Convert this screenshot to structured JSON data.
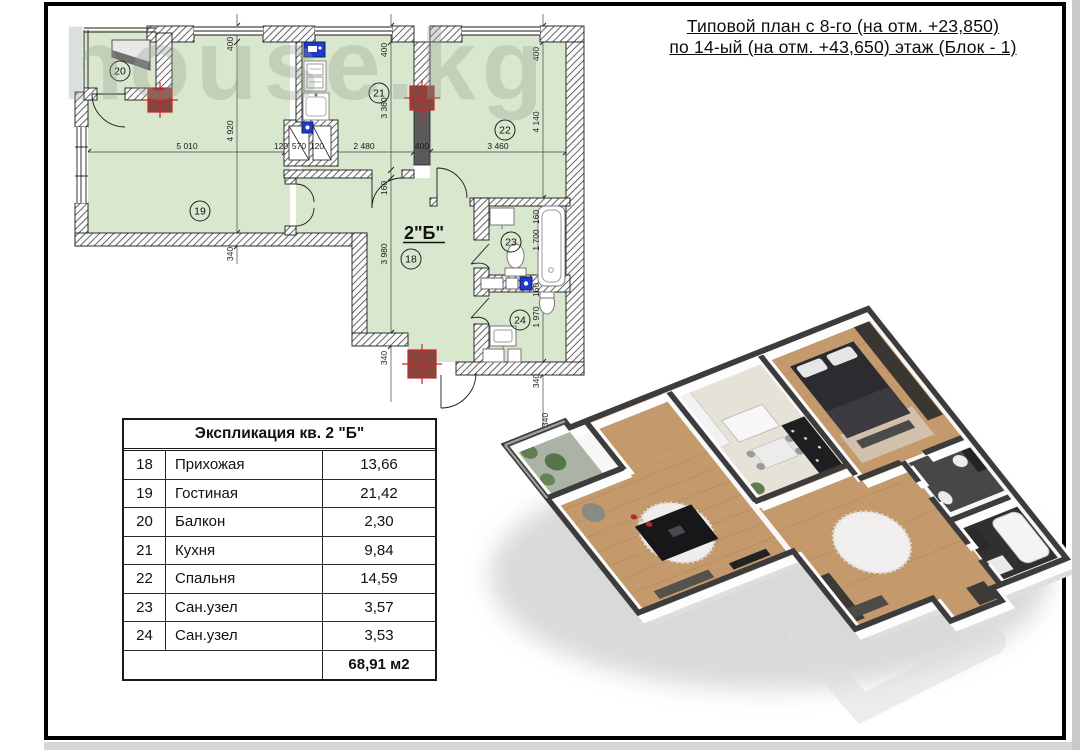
{
  "title": {
    "line1": "Типовой план с 8-го (на отм. +23,850)",
    "line2": "по 14-ый (на отм. +43,650) этаж (Блок - 1)"
  },
  "watermark": {
    "text": "house.kg"
  },
  "floor_plan": {
    "apartment_label": "2\"Б\"",
    "rooms": [
      {
        "n": "18"
      },
      {
        "n": "19"
      },
      {
        "n": "20"
      },
      {
        "n": "21"
      },
      {
        "n": "22"
      },
      {
        "n": "23"
      },
      {
        "n": "24"
      }
    ],
    "dims": {
      "h": [
        "5 010",
        "120",
        "570",
        "120",
        "2 480",
        "400",
        "3 460"
      ],
      "left": [
        "400",
        "4 920",
        "340"
      ],
      "mid": [
        "400",
        "3 360",
        "160",
        "3 980",
        "340"
      ],
      "right": [
        "400",
        "4 140",
        "160",
        "1 700",
        "160",
        "1 970",
        "340",
        "340"
      ]
    },
    "colors": {
      "room_fill": "#d8e7cd",
      "wall_hatch": "#3f3f3f",
      "column_red": "#c62828",
      "fixture_blue": "#1d3bc8"
    }
  },
  "table": {
    "title": "Экспликация кв. 2 \"Б\"",
    "rows": [
      {
        "num": "18",
        "name": "Прихожая",
        "area": "13,66"
      },
      {
        "num": "19",
        "name": "Гостиная",
        "area": "21,42"
      },
      {
        "num": "20",
        "name": "Балкон",
        "area": "2,30"
      },
      {
        "num": "21",
        "name": "Кухня",
        "area": "9,84"
      },
      {
        "num": "22",
        "name": "Спальня",
        "area": "14,59"
      },
      {
        "num": "23",
        "name": "Сан.узел",
        "area": "3,57"
      },
      {
        "num": "24",
        "name": "Сан.узел",
        "area": "3,53"
      }
    ],
    "total": "68,91 м2"
  }
}
